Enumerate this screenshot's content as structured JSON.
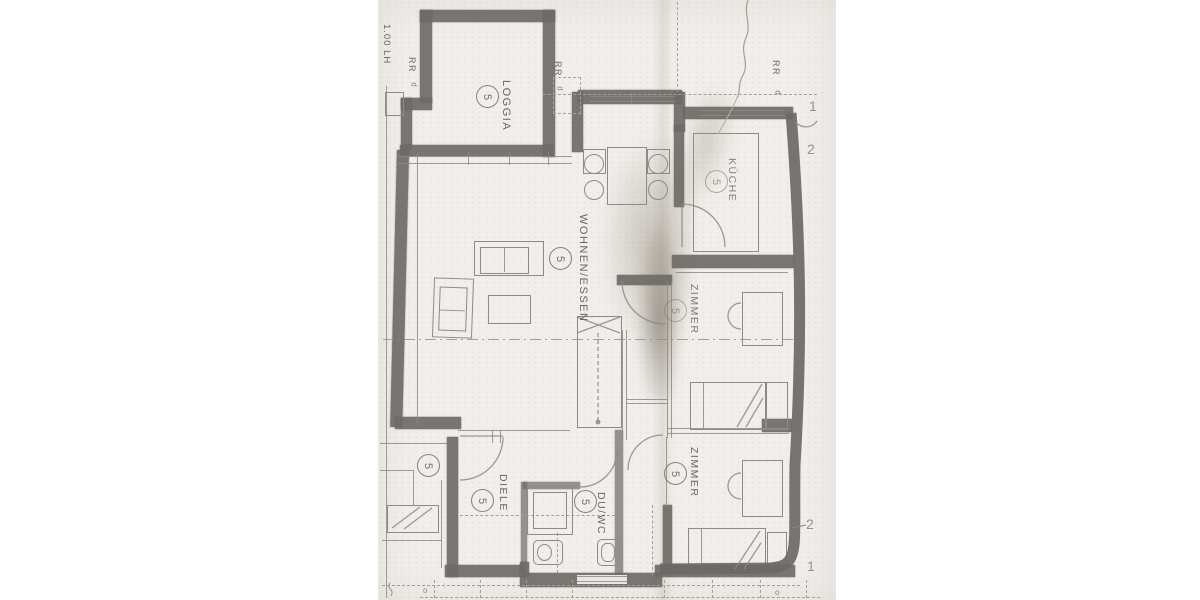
{
  "rooms": [
    {
      "name": "loggia",
      "label": "LOGGIA",
      "unit": "5"
    },
    {
      "name": "kueche",
      "label": "KÜCHE",
      "unit": "5"
    },
    {
      "name": "wohnen-essen",
      "label": "WOHNEN/ESSEN",
      "unit": "5"
    },
    {
      "name": "zimmer-nord",
      "label": "ZIMMER",
      "unit": "5"
    },
    {
      "name": "zimmer-sued",
      "label": "ZIMMER",
      "unit": "5"
    },
    {
      "name": "diele",
      "label": "DIELE",
      "unit": "5"
    },
    {
      "name": "du-wc",
      "label": "DU/WC",
      "unit": "5"
    }
  ],
  "stairwell_unit_marker": "5",
  "annotations": {
    "parapet_height": "1.00 LH",
    "rr_1": "RR",
    "rr_1_sub": "d",
    "rr_2": "RR",
    "rr_2_sub": "d",
    "rr_3": "RR",
    "rr_3_sub": "d",
    "edge_top_1": "1",
    "edge_top_2": "2",
    "edge_bottom_2": "2",
    "edge_bottom_1": "1",
    "mark_left": "o",
    "mark_right": "o"
  },
  "colors": {
    "margin": "#ffffff",
    "paper": "#f1efeb",
    "wall": "#6e6c67",
    "line": "#8d8b86",
    "text": "#56544f"
  }
}
